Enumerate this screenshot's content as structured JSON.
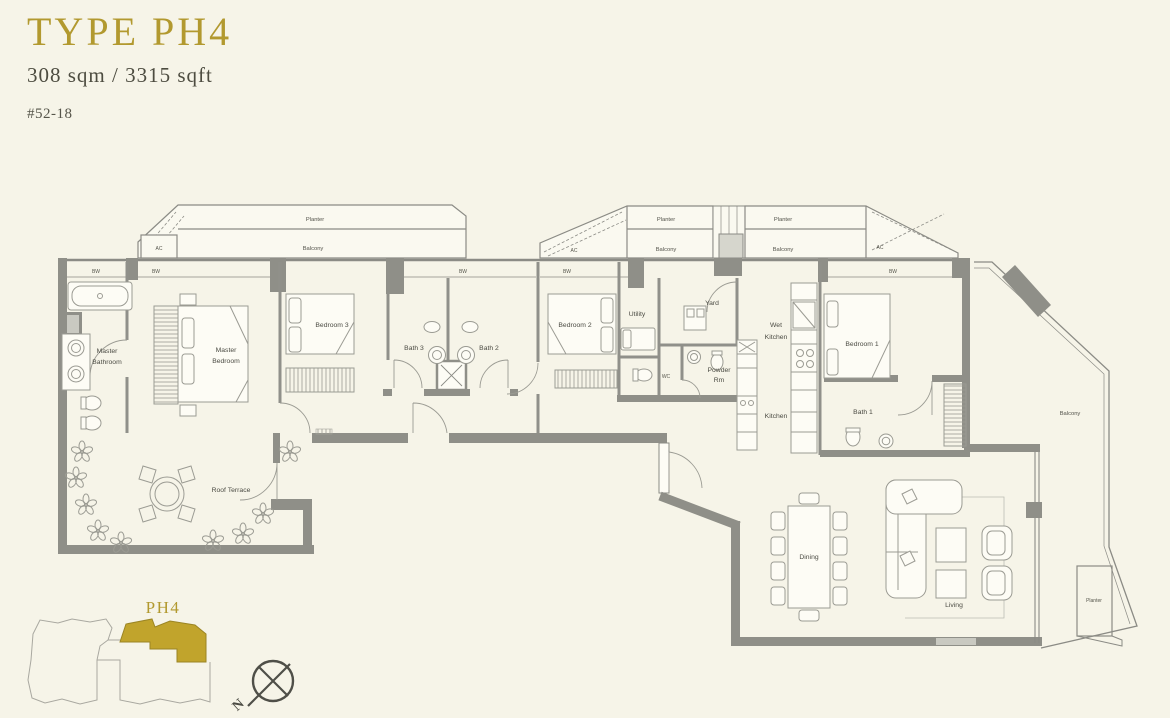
{
  "header": {
    "type_title": "TYPE PH4",
    "area": "308 sqm / 3315 sqft",
    "unit_number": "#52-18"
  },
  "plan": {
    "labels": {
      "planter": "Planter",
      "balcony": "Balcony",
      "ac": "AC",
      "bw": "BW",
      "master_bathroom": [
        "Master",
        "Bathroom"
      ],
      "master_bedroom": [
        "Master",
        "Bedroom"
      ],
      "bedroom3": "Bedroom 3",
      "bath3": "Bath 3",
      "bath2": "Bath 2",
      "bedroom2": "Bedroom 2",
      "utility": "Utility",
      "yard": "Yard",
      "wc": "WC",
      "powder_room": [
        "Powder",
        "Rm"
      ],
      "wet_kitchen": [
        "Wet",
        "Kitchen"
      ],
      "kitchen": "Kitchen",
      "bedroom1": "Bedroom 1",
      "bath1": "Bath 1",
      "roof_terrace": "Roof Terrace",
      "dining": "Dining",
      "living": "Living"
    }
  },
  "keyplan": {
    "unit_label": "PH4"
  },
  "compass": {
    "north_label": "N"
  },
  "colors": {
    "background": "#f6f4e8",
    "accent_gold": "#b2992f",
    "keyplan_unit_fill": "#c1a42c",
    "wall_gray": "#8f8f88",
    "text_dark": "#4b4b43"
  }
}
